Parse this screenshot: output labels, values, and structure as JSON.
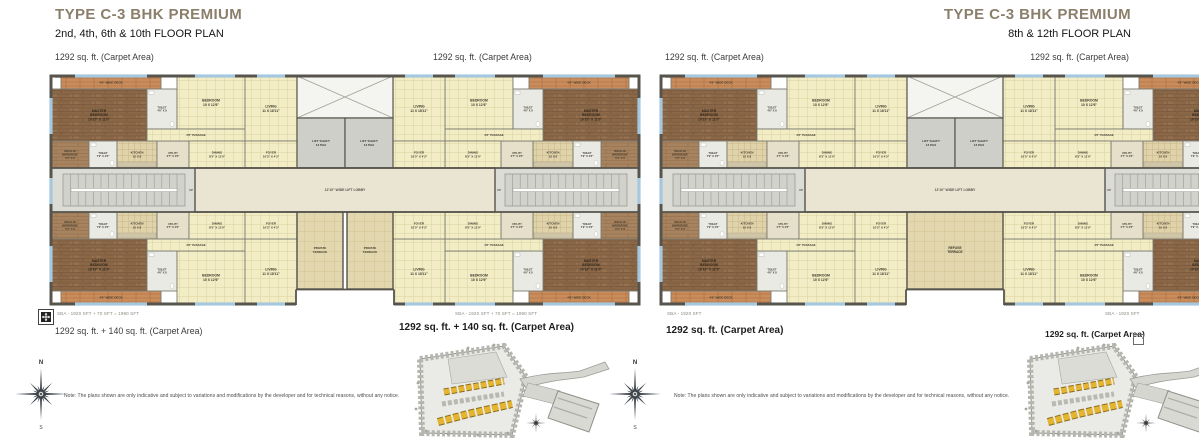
{
  "plans": [
    {
      "title": "TYPE C-3 BHK PREMIUM",
      "subtitle": "2nd, 4th, 6th & 10th FLOOR PLAN",
      "carpet_top_left": "1292 sq. ft. (Carpet Area)",
      "carpet_top_right": "1292 sq. ft. (Carpet Area)",
      "carpet_bottom_left": "1292 sq. ft. + 140 sq. ft. (Carpet Area)",
      "carpet_bottom_right": "1292 sq. ft. + 140 sq. ft. (Carpet Area)",
      "sba_top_left": "SBA - 1920 SFT",
      "sba_top_right": "SBA - 1920 SFT",
      "sba_bottom_left": "SBA - 1920 SFT + 70 SFT = 1990 SFT",
      "sba_bottom_right": "SBA - 1920 SFT + 70 SFT = 1990 SFT",
      "variant": "private_terrace",
      "note": "Note: The plans shown are only indicative and subject to variations and modifications by the developer and for technical reasons, without any notice."
    },
    {
      "title": "TYPE C-3 BHK PREMIUM",
      "subtitle": "8th & 12th FLOOR PLAN",
      "carpet_top_left": "1292 sq. ft. (Carpet Area)",
      "carpet_top_right": "1292 sq. ft. (Carpet Area)",
      "carpet_bottom_left": "1292 sq. ft. (Carpet Area)",
      "carpet_bottom_right": "1292 sq. ft. (Carpet Area)",
      "sba_top_left": "SBA - 1920 SFT",
      "sba_top_right": "SBA - 1920 SFT",
      "sba_bottom_left": "SBA - 1920 SFT",
      "sba_bottom_right": "SBA - 1920 SFT",
      "variant": "refuge_terrace",
      "note": "Note: The plans shown are only indicative and subject to variations and modifications by the developer and for technical reasons, without any notice."
    }
  ],
  "floorplan": {
    "rooms": {
      "master_bedroom": [
        "MASTER",
        "BEDROOM",
        "10'10\" X 11'0\""
      ],
      "bedroom": [
        "BEDROOM",
        "10 X 12'6\""
      ],
      "living": [
        "LIVING",
        "11 X 18'11\""
      ],
      "dining": [
        "DINING",
        "8'3\" X 11'0\""
      ],
      "kitchen": [
        "KITCHEN",
        "10 X 8"
      ],
      "foyer": [
        "FOYER",
        "10'3\" X 4'3\""
      ],
      "toilet": [
        "TOILET",
        "4'6\" X 8"
      ],
      "toilet_small": [
        "TOILET",
        "7'9\" X 4'6\""
      ],
      "walk_in_wardrobe": [
        "WALK-IN",
        "WARDROBE",
        "5'3\" X 8"
      ],
      "utility": [
        "UTILITY",
        "2'7\" X 4'6\""
      ],
      "passage": [
        "3'6\" PASSAGE"
      ],
      "lift_shaft": [
        "LIFT SHAFT",
        "13 PAX"
      ],
      "lift_lobby": [
        "12'10\" WIDE LIFT LOBBY"
      ],
      "deck": [
        "4'6\" WIDE DECK"
      ],
      "private_terrace": [
        "PRIVATE",
        "TERRACE"
      ],
      "refuge_terrace": [
        "REFUGE",
        "TERRACE"
      ],
      "up": [
        "UP"
      ]
    },
    "colors": {
      "wall": "#56544c",
      "wall_light": "#7b7a70",
      "cream": "#f2edc5",
      "cream_line": "#dbd1a3",
      "tile": "#e0d2a9",
      "tile_line": "#c8b78a",
      "wood": "#8a6747",
      "wood_line": "#745139",
      "wood_light": "#a8835f",
      "wood_light_line": "#8f6c49",
      "deck": "#c98c5b",
      "deck_line": "#ad6f41",
      "toilet": "#eaeae4",
      "utility_fill": "#e6dfca",
      "corridor": "#dcdcd6",
      "stair": "#d2d2cc",
      "stair_line": "#9a9a92",
      "lobby": "#eae4d3",
      "terrace": "#e2d7ae",
      "terrace_line": "#cfc28f",
      "window": "#a5c8de",
      "label": "#3e3a2d",
      "map_yellow": "#e6b52f"
    }
  },
  "compass": {
    "north": "N",
    "south": "S"
  }
}
